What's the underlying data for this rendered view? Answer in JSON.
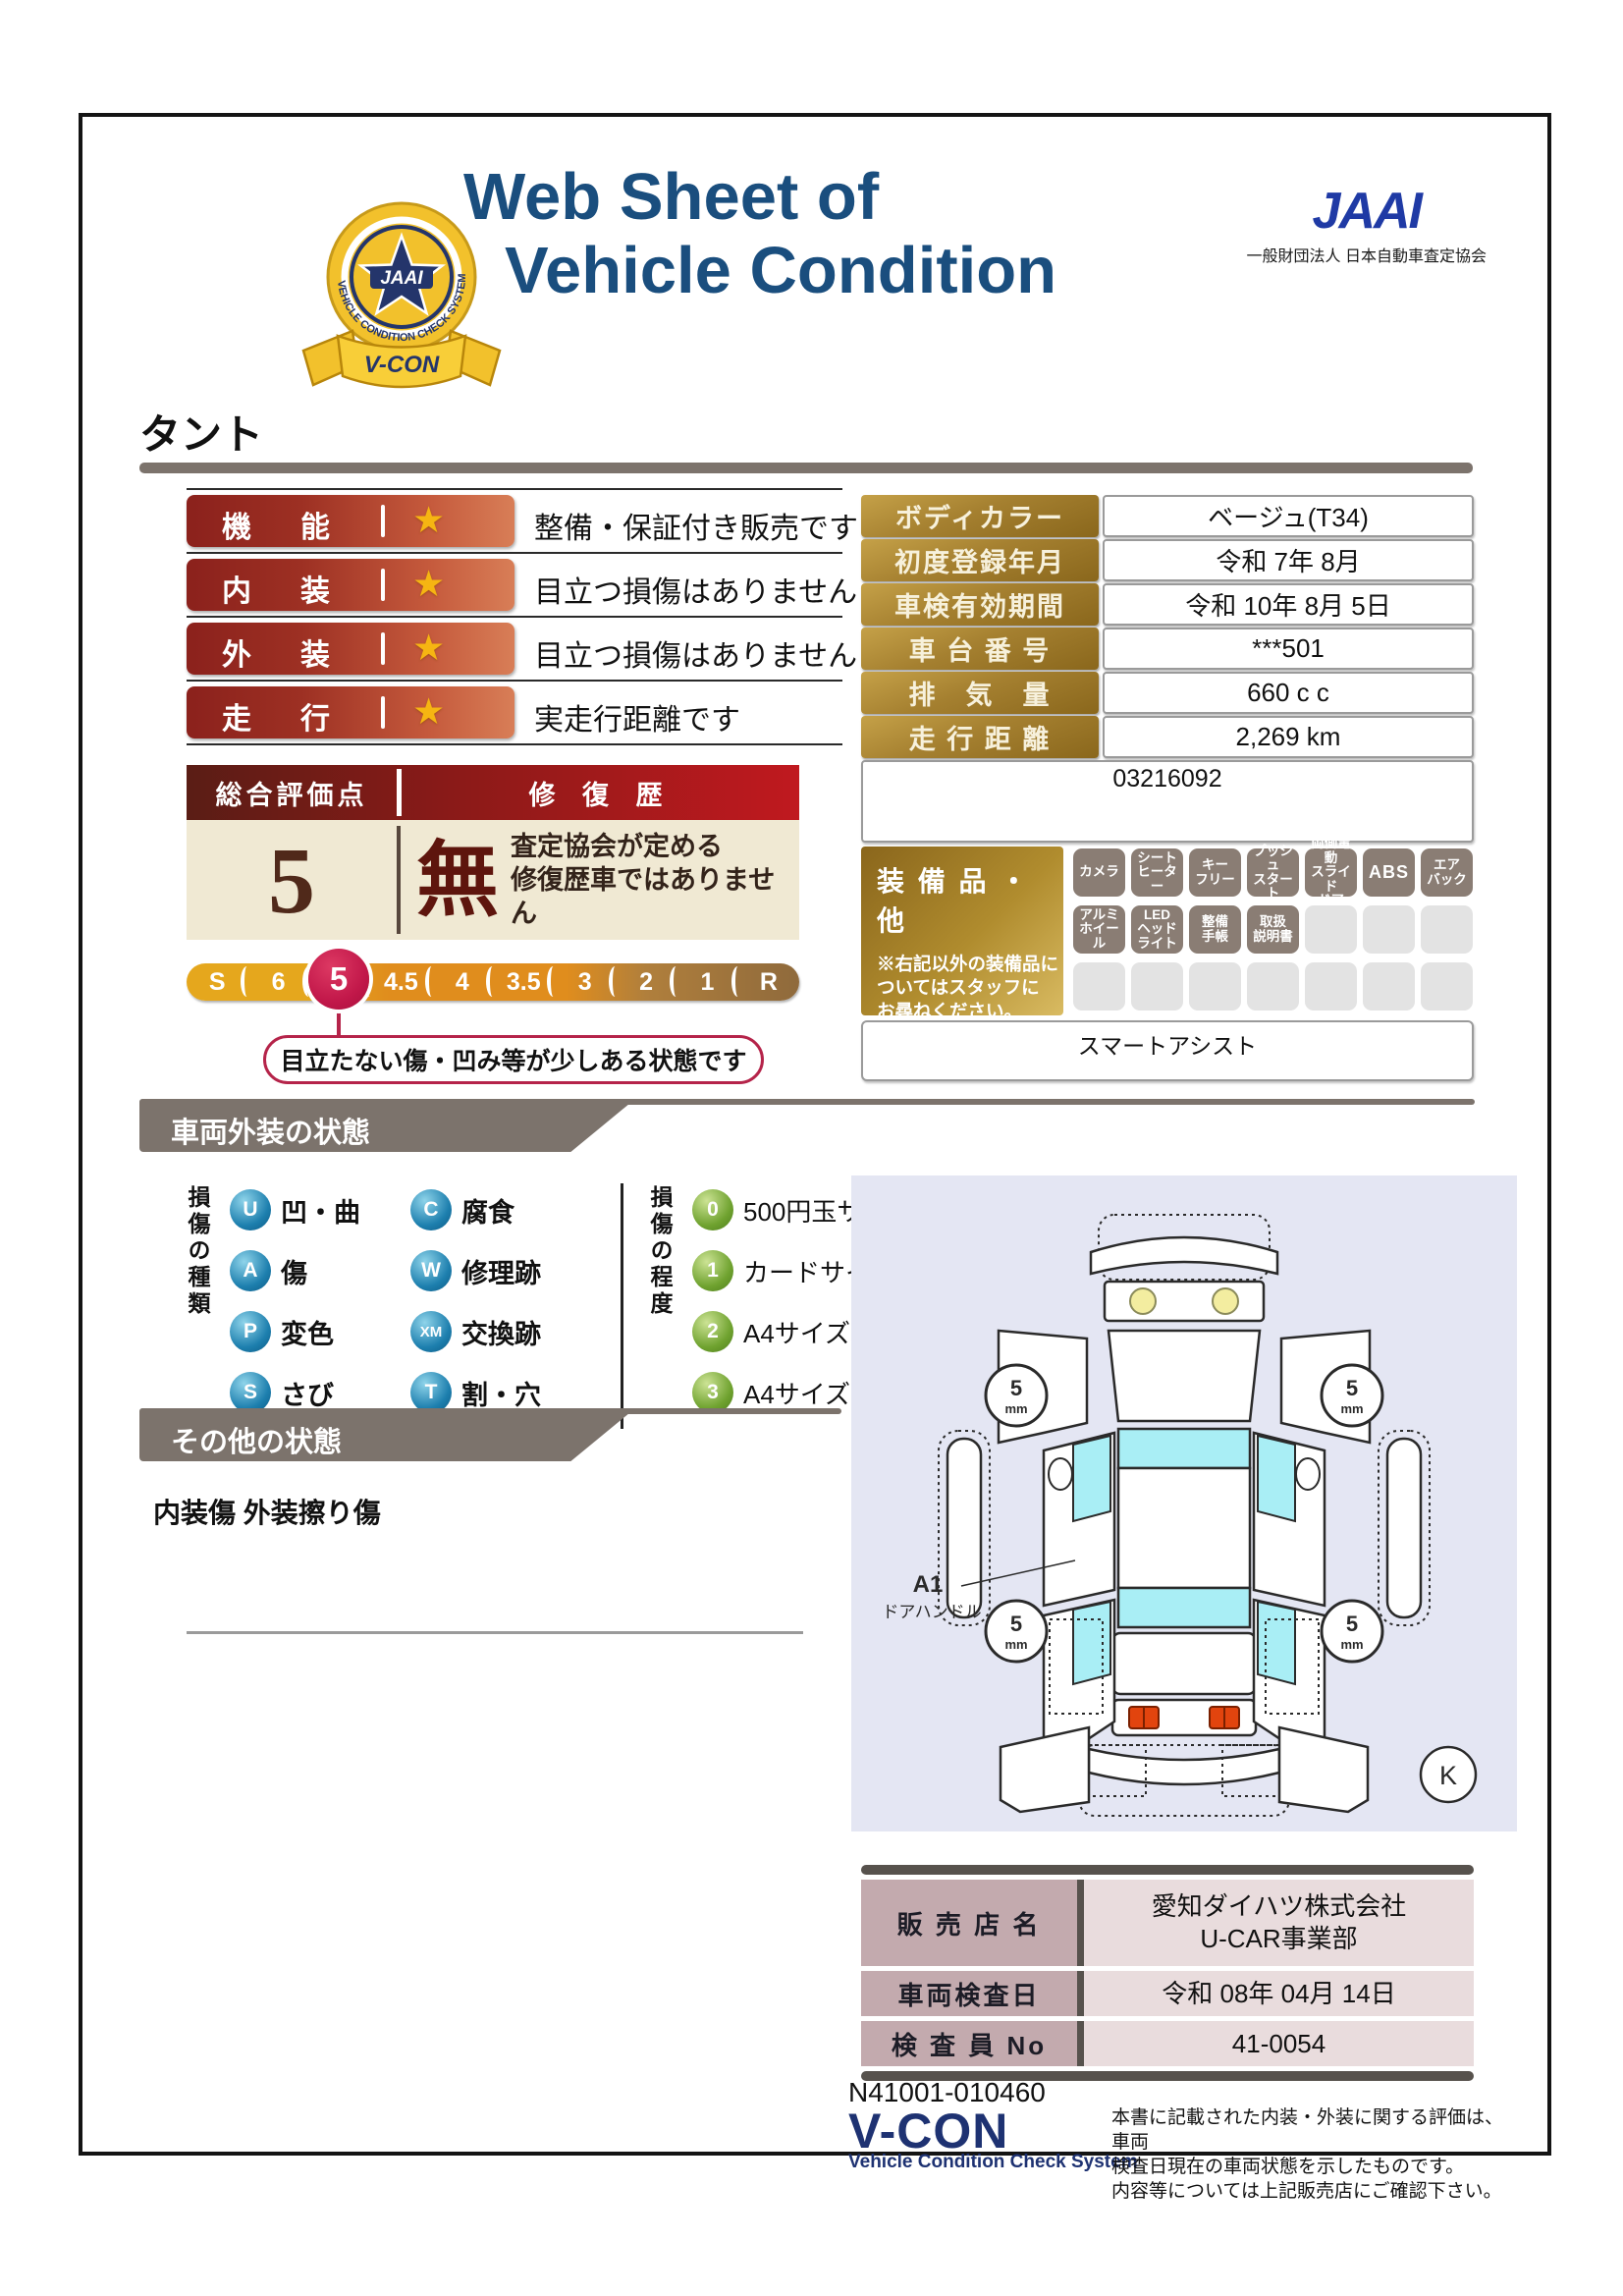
{
  "header": {
    "title_line1": "Web Sheet of",
    "title_line2": "Vehicle Condition",
    "jaai_logo": "JAAI",
    "jaai_subtitle": "一般財団法人 日本自動車査定協会",
    "badge": {
      "jaai": "JAAI",
      "ring_text": "VEHICLE CONDITION CHECK SYSTEM",
      "ribbon": "V-CON"
    }
  },
  "vehicle_name": "タント",
  "ratings": [
    {
      "label": "機能",
      "description": "整備・保証付き販売です"
    },
    {
      "label": "内装",
      "description": "目立つ損傷はありません"
    },
    {
      "label": "外装",
      "description": "目立つ損傷はありません"
    },
    {
      "label": "走行",
      "description": "実走行距離です"
    }
  ],
  "overall": {
    "header_left": "総合評価点",
    "header_right": "修 復 歴",
    "score": "5",
    "repair_mark": "無",
    "repair_note": "査定協会が定める\n修復歴車ではありません",
    "scale": [
      "S",
      "6",
      "5",
      "4.5",
      "4",
      "3.5",
      "3",
      "2",
      "1",
      "R"
    ],
    "selected": "5",
    "callout": "目立たない傷・凹み等が少しある状態です"
  },
  "details": {
    "rows": [
      {
        "label": "ボディカラー",
        "value": "ベージュ(T34)"
      },
      {
        "label": "初度登録年月",
        "value": "令和 7年 8月"
      },
      {
        "label": "車検有効期間",
        "value": "令和 10年 8月 5日"
      },
      {
        "label": "車 台 番 号",
        "value": "***501"
      },
      {
        "label": "排　気　量",
        "value": "660 c c"
      },
      {
        "label": "走 行 距 離",
        "value": "2,269 km"
      }
    ],
    "serial": "03216092"
  },
  "equipment": {
    "title": "装 備 品 ・ 他",
    "note": "※右記以外の装備品に\nついてはスタッフに\nお尋ねください。",
    "cells": [
      "カメラ",
      "シート\nヒーター",
      "キー\nフリー",
      "プッシュ\nスタート",
      "両側電動\nスライド\nドア",
      "ABS",
      "エア\nバック",
      "アルミ\nホイール",
      "LED\nヘッド\nライト",
      "整備\n手帳",
      "取扱\n説明書"
    ],
    "footer": "スマートアシスト"
  },
  "exterior": {
    "title": "車両外装の状態",
    "type_group_label": "損傷の種類",
    "types": [
      {
        "code": "U",
        "label": "凹・曲"
      },
      {
        "code": "A",
        "label": "傷"
      },
      {
        "code": "P",
        "label": "変色"
      },
      {
        "code": "S",
        "label": "さび"
      },
      {
        "code": "C",
        "label": "腐食"
      },
      {
        "code": "W",
        "label": "修理跡"
      },
      {
        "code": "XM",
        "label": "交換跡"
      },
      {
        "code": "T",
        "label": "割・穴"
      }
    ],
    "degree_group_label": "損傷の程度",
    "degrees": [
      {
        "code": "0",
        "label": "500円玉サイズ未満"
      },
      {
        "code": "1",
        "label": "カードサイズ未満"
      },
      {
        "code": "2",
        "label": "A4サイズ未満"
      },
      {
        "code": "3",
        "label": "A4サイズ以上"
      }
    ]
  },
  "other_condition": {
    "title": "その他の状態",
    "text": "内装傷 外装擦り傷"
  },
  "diagram": {
    "wheel_value": "5",
    "wheel_unit": "mm",
    "annotation_code": "A1",
    "annotation_label": "ドアハンドル",
    "corner_mark": "K"
  },
  "dealer": {
    "rows": [
      {
        "label": "販 売 店 名",
        "value": "愛知ダイハツ株式会社\nU-CAR事業部"
      },
      {
        "label": "車両検査日",
        "value": "令和 08年 04月 14日"
      },
      {
        "label": "検 査 員 No",
        "value": "41-0054"
      }
    ]
  },
  "footer": {
    "serial": "N41001-010460",
    "vcon": "V-CON",
    "vcon_sub": "Vehicle Condition Check System",
    "note": "本書に記載された内装・外装に関する評価は、車両\n検査日現在の車両状態を示したものです。\n内容等については上記販売店にご確認下さい。"
  },
  "colors": {
    "accent_navy": "#1a4e7e",
    "jaai_blue": "#1f3aa5",
    "rating_red": "#8b211c",
    "gold": "#a58030",
    "crimson": "#c2184a",
    "taupe": "#7c736c",
    "diagram_bg": "#e4e6f3",
    "window_cyan": "#a9eef5"
  }
}
